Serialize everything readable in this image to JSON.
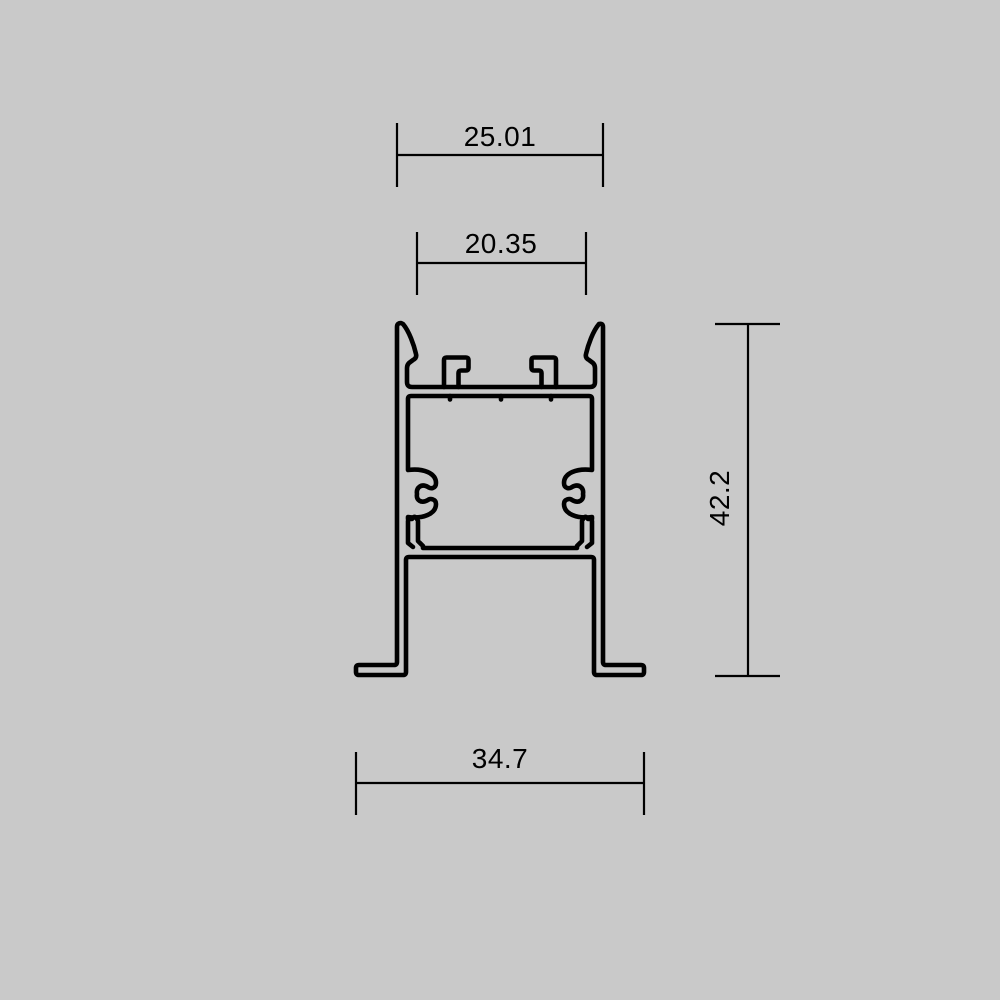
{
  "drawing": {
    "type": "profile-cross-section-technical-drawing",
    "dimensions": {
      "top_width": "25.01",
      "opening_width": "20.35",
      "overall_height": "42.2",
      "bottom_width": "34.7"
    },
    "colors": {
      "background": "#c9c9c9",
      "line": "#000000",
      "text": "#000000"
    }
  }
}
